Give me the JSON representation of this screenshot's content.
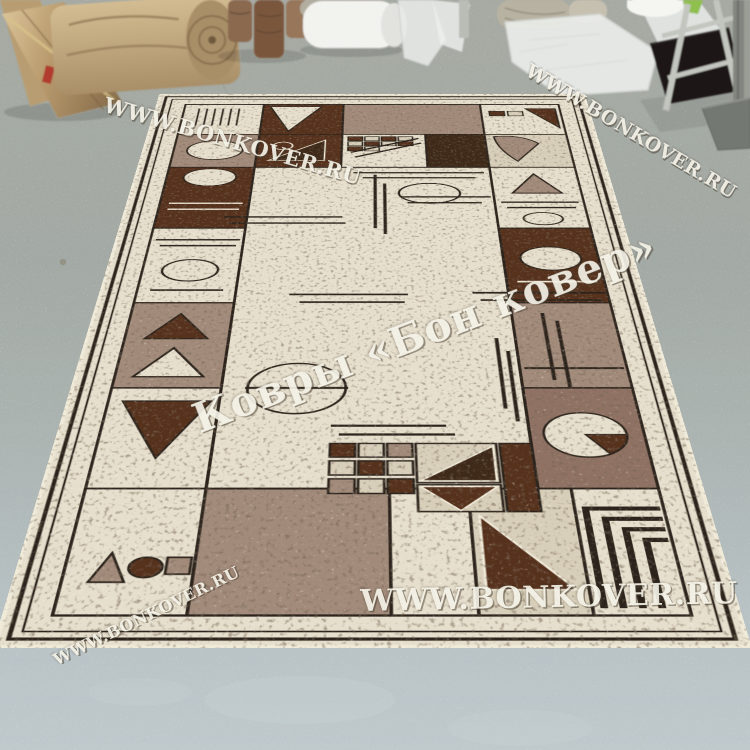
{
  "watermarks": {
    "top_left": "WWW.BONKOVER.RU",
    "top_right": "WWW.BONKOVER.RU",
    "center": "Ковры «Бон ковер»",
    "bottom": "WWW.BONKOVER.RU",
    "bottom_left": "WWW.BONKOVER.RU"
  },
  "palette": {
    "floor-top": "#a6aaa3",
    "floor-mid": "#a9b1ae",
    "floor-bottom": "#bdc7ca",
    "rug-cream": "#e7dfcd",
    "rug-cream-dark": "#d8cfba",
    "rug-taupe": "#a28b7b",
    "rug-mauve": "#8f7263",
    "rug-brown": "#56321d",
    "rug-brown-deep": "#3f2a19",
    "rug-line": "#2c241c",
    "rug-fringe": "#f0ead9",
    "roll-tan": "#c7ab7f",
    "roll-brown": "#826044",
    "plastic": "#eceeeb",
    "rack": "#c3c6bf",
    "box": "#1c1917",
    "wall": "#82867f",
    "watermark-ivory": "#f4f1e6"
  }
}
